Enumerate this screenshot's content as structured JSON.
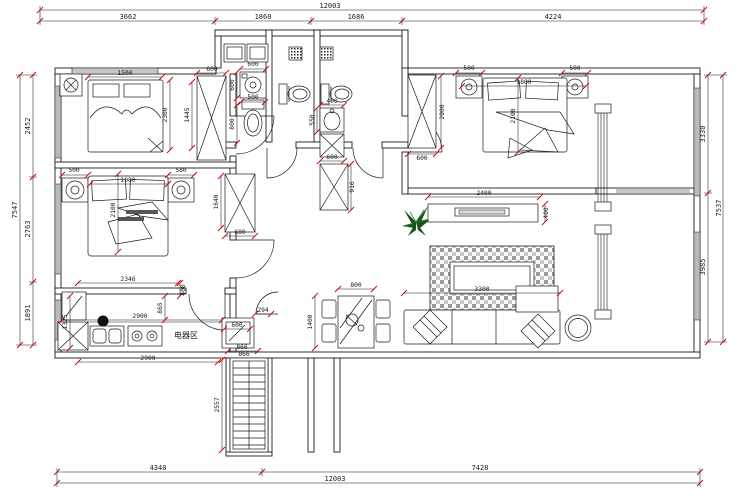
{
  "labels": {
    "appliance_zone": "电器区"
  },
  "colors": {
    "line": "#1b1b1b",
    "marker": "#cc0000",
    "plant_dark": "#175417",
    "rug_gray": "#9a9a9a"
  },
  "dims": {
    "top": {
      "overall": "12003",
      "s1": "3662",
      "s2": "1860",
      "s3": "1686",
      "s4": "4224"
    },
    "bottom": {
      "s1": "4340",
      "s2": "7428",
      "overall": "12003"
    },
    "left": {
      "overall": "7547",
      "s1": "2452",
      "s2": "2763",
      "s3": "1891"
    },
    "right": {
      "s1": "3330",
      "s2": "3985",
      "overall": "7537"
    },
    "bed1": {
      "bed_w": "1500",
      "bed_l": "2300",
      "ward_w": "600",
      "ward_h": "1445"
    },
    "laundry": {
      "washer_w": "600",
      "washer_d": "600",
      "toilet_w": "500",
      "toilet_d": "800"
    },
    "bath": {
      "basin_w": "400",
      "basin_d": "550",
      "cab_w": "600",
      "cab_h": "916"
    },
    "bed2": {
      "ns_l": "500",
      "ns_r": "580",
      "bed_w": "1080",
      "bed_l": "2100",
      "ward_h": "1640",
      "ward_w": "680"
    },
    "kitchen": {
      "top": "2346",
      "top_side": "400",
      "depth_left": "1325",
      "depth_mid": "865",
      "mid": "2900",
      "bottom": "2900",
      "fridge_w": "600",
      "fridge_d": "866",
      "gap": "294"
    },
    "master": {
      "ward_h": "2000",
      "ward_w": "600",
      "ns_l": "500",
      "ns_r": "500",
      "bed_w": "1800",
      "bed_l": "2100"
    },
    "living": {
      "tv_wall": "2400",
      "tv_d": "400",
      "rug": "3300"
    },
    "dining": {
      "table_w": "800",
      "table_l": "1400"
    },
    "hall": {
      "cab_w": "866",
      "cab_h": "2557"
    }
  }
}
